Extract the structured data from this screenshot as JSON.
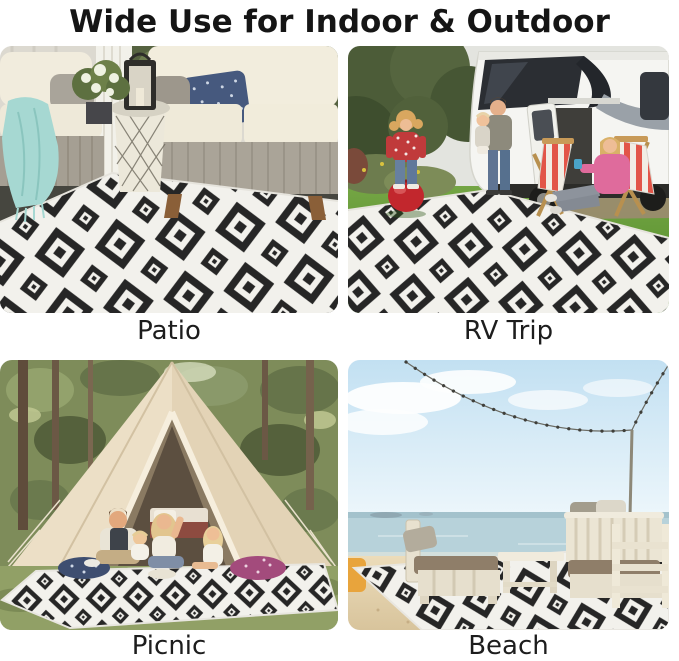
{
  "page": {
    "title": "Wide Use for Indoor & Outdoor",
    "background": "#ffffff"
  },
  "sections": [
    {
      "id": "patio",
      "label": "Patio",
      "alt": "Black and white geometric diamond rug on a dark tile patio with cream outdoor sofas, a teal throw blanket, a navy pillow and a black lantern on a lattice drum table"
    },
    {
      "id": "rv",
      "label": "RV Trip",
      "alt": "Family beside a white RV: girl bouncing on a red ball, father holding a toddler, mother in pink relaxing on a striped wooden deck chair, rug spread on the grass"
    },
    {
      "id": "picnic",
      "label": "Picnic",
      "alt": "Family picnicking on the rug in front of a beige bell tent in a forest clearing"
    },
    {
      "id": "beach",
      "label": "Beach",
      "alt": "Rug laid on beach sand with whitewashed wooden furniture, string lights, calm sea and blue sky"
    }
  ],
  "colors": {
    "rug_black": "#262626",
    "rug_white": "#f2f1ec",
    "title_text": "#151515",
    "caption_text": "#1d1d1d",
    "teal_blanket": "#a6d8d2",
    "red_ball": "#c2272d",
    "pink_hoodie": "#df6b9c",
    "tent_canvas": "#e9dabf",
    "sky_blue": "#c2e0f2",
    "sand": "#e2cfa8",
    "grass_green": "#6fa03b"
  }
}
